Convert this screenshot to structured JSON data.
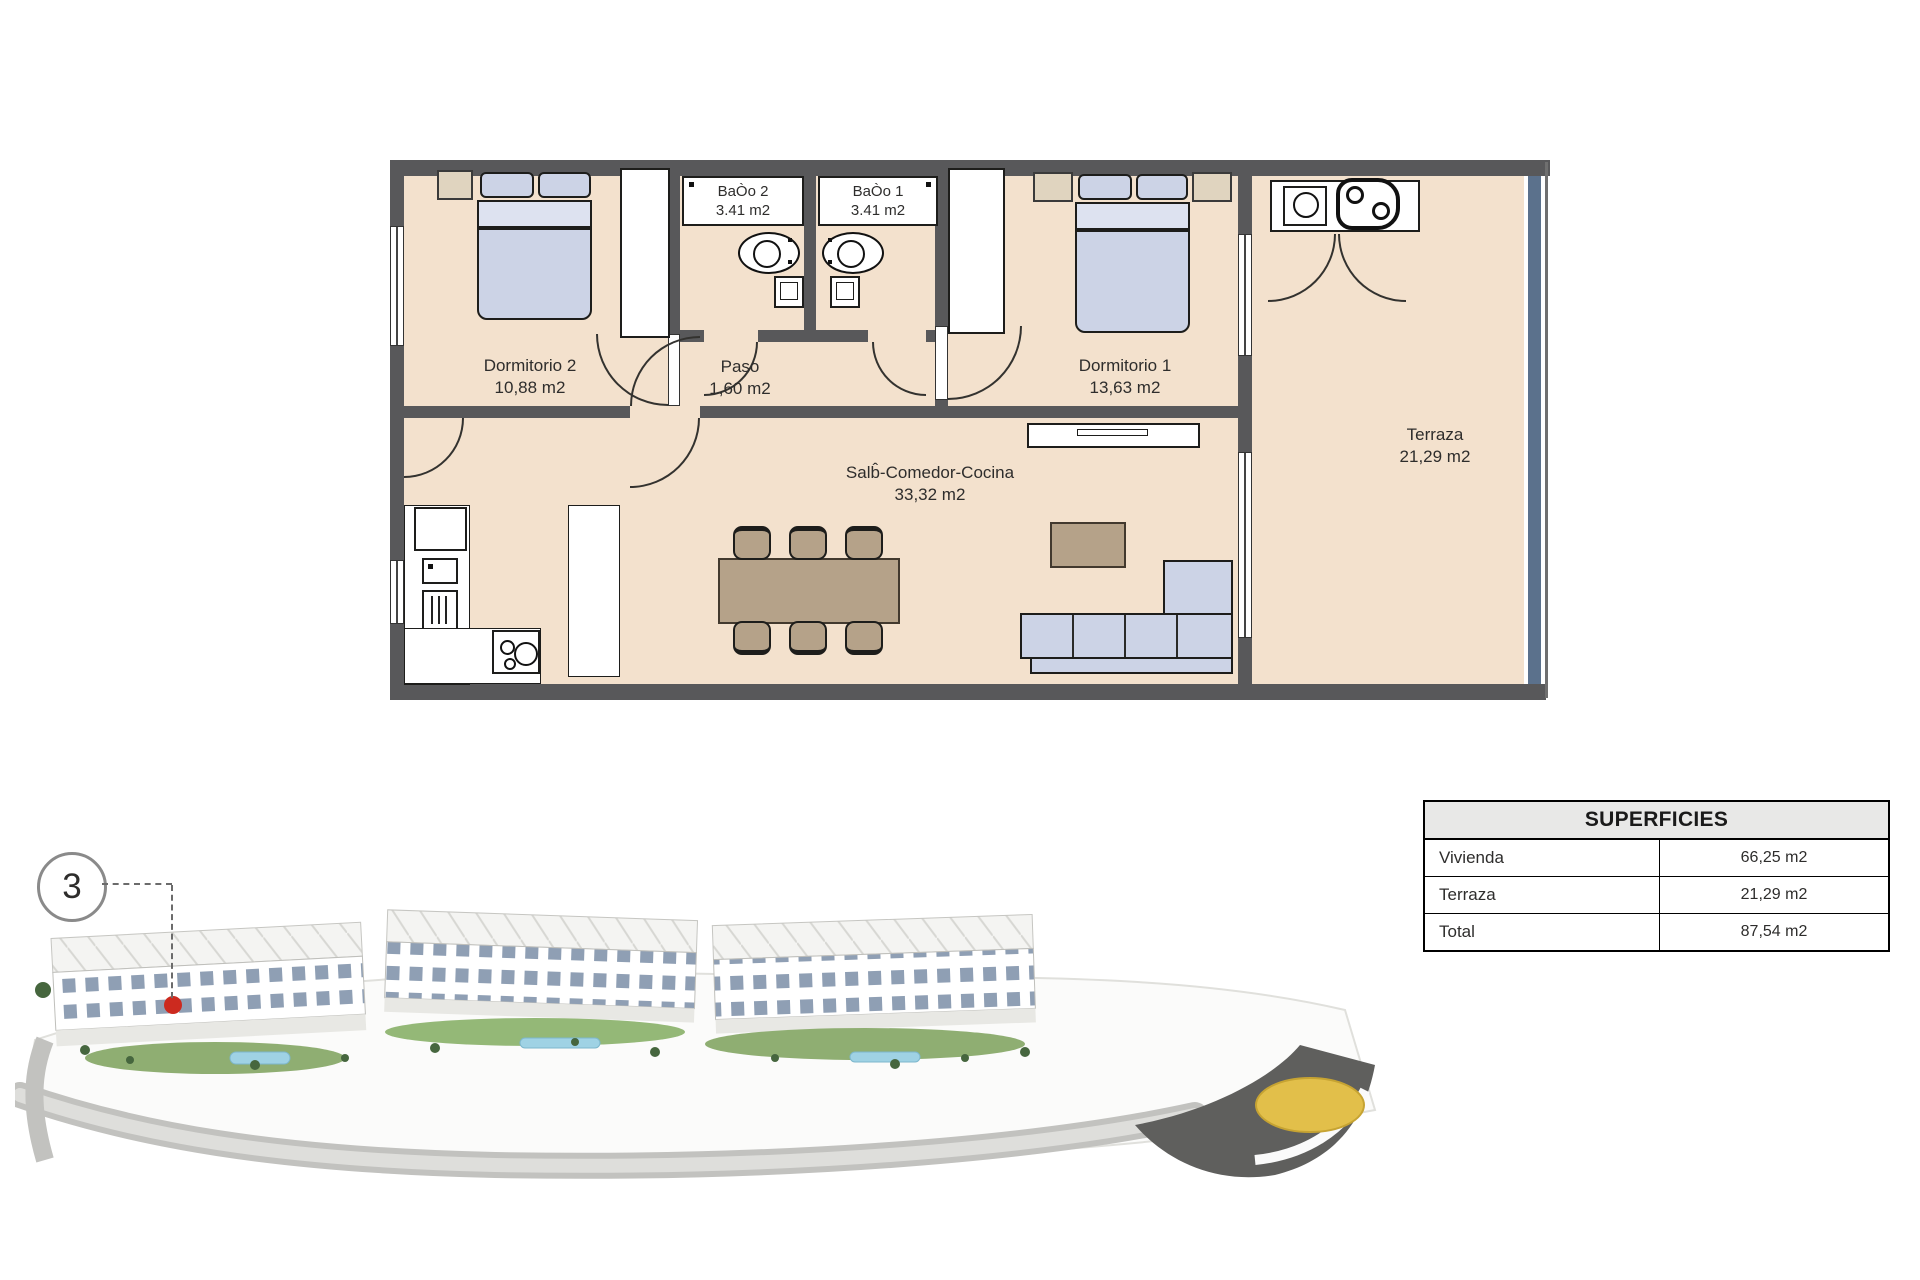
{
  "floorplan": {
    "rooms": {
      "dormitorio2": {
        "name": "Dormitorio 2",
        "area": "10,88 m2"
      },
      "paso": {
        "name": "Paso",
        "area": "1,60 m2"
      },
      "bano2": {
        "name": "BaÒo 2",
        "area": "3.41 m2"
      },
      "bano1": {
        "name": "BaÒo 1",
        "area": "3.41 m2"
      },
      "dormitorio1": {
        "name": "Dormitorio 1",
        "area": "13,63 m2"
      },
      "salon": {
        "name": "Salb̂-Comedor-Cocina",
        "area": "33,32 m2"
      },
      "terraza": {
        "name": "Terraza",
        "area": "21,29 m2"
      }
    },
    "colors": {
      "wall": "#58585a",
      "floor": "#f3e1cd",
      "furniture_blue": "#ccd3e6",
      "furniture_tan": "#b5a289",
      "wood_light": "#e0d4bf",
      "terrace_railing": "#5b718c"
    }
  },
  "surfaces_table": {
    "title": "SUPERFICIES",
    "rows": [
      {
        "label": "Vivienda",
        "value": "66,25 m2"
      },
      {
        "label": "Terraza",
        "value": "21,29 m2"
      },
      {
        "label": "Total",
        "value": "87,54 m2"
      }
    ]
  },
  "site_plan": {
    "marker_number": "3",
    "marker_color": "#cc2a1f",
    "roundabout_color": "#e2bf4a"
  }
}
